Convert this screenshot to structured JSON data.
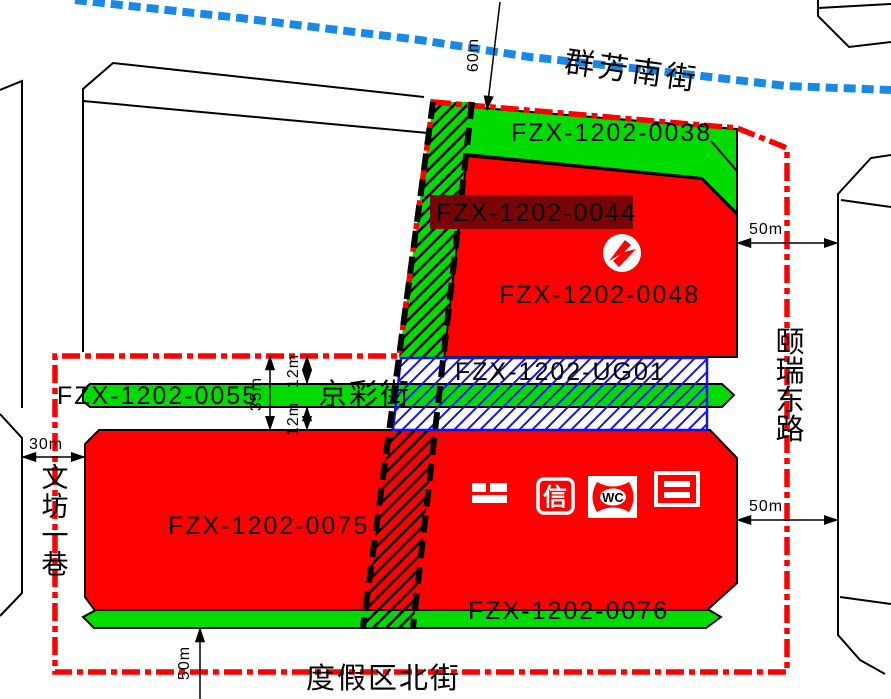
{
  "map": {
    "colors": {
      "parcel_red": "#FE0000",
      "green": "#00DC00",
      "selected_label_bg": "#7A0404",
      "blue": "#1414E6",
      "road_blue": "#1989E8",
      "boundary_red": "#FE0000",
      "black": "#000000",
      "white": "#FFFFFF"
    }
  },
  "parcels": {
    "p0038": {
      "label": "FZX-1202-0038"
    },
    "p0044": {
      "label": "FZX-1202-0044"
    },
    "p0048": {
      "label": "FZX-1202-0048"
    },
    "ug01": {
      "label": "FZX-1202-UG01"
    },
    "p0055": {
      "label": "FZX-1202-0055"
    },
    "p0075": {
      "label": "FZX-1202-0075"
    },
    "p0076": {
      "label": "FZX-1202-0076"
    }
  },
  "streets": {
    "north": "群芳南街",
    "middle": "京彩街",
    "south": "度假区北街",
    "west": "文坊一巷",
    "east": "颐瑞东路"
  },
  "dimensions": {
    "north_road_width": "60m",
    "east_road_width_top": "50m",
    "east_road_width_bottom": "50m",
    "south_road_width": "50m",
    "west_road_width": "30m",
    "middle_total": "35m",
    "middle_north": "12m",
    "middle_south": "12m"
  },
  "icons": {
    "telecom_text": "信",
    "toilet_text": "WC"
  }
}
